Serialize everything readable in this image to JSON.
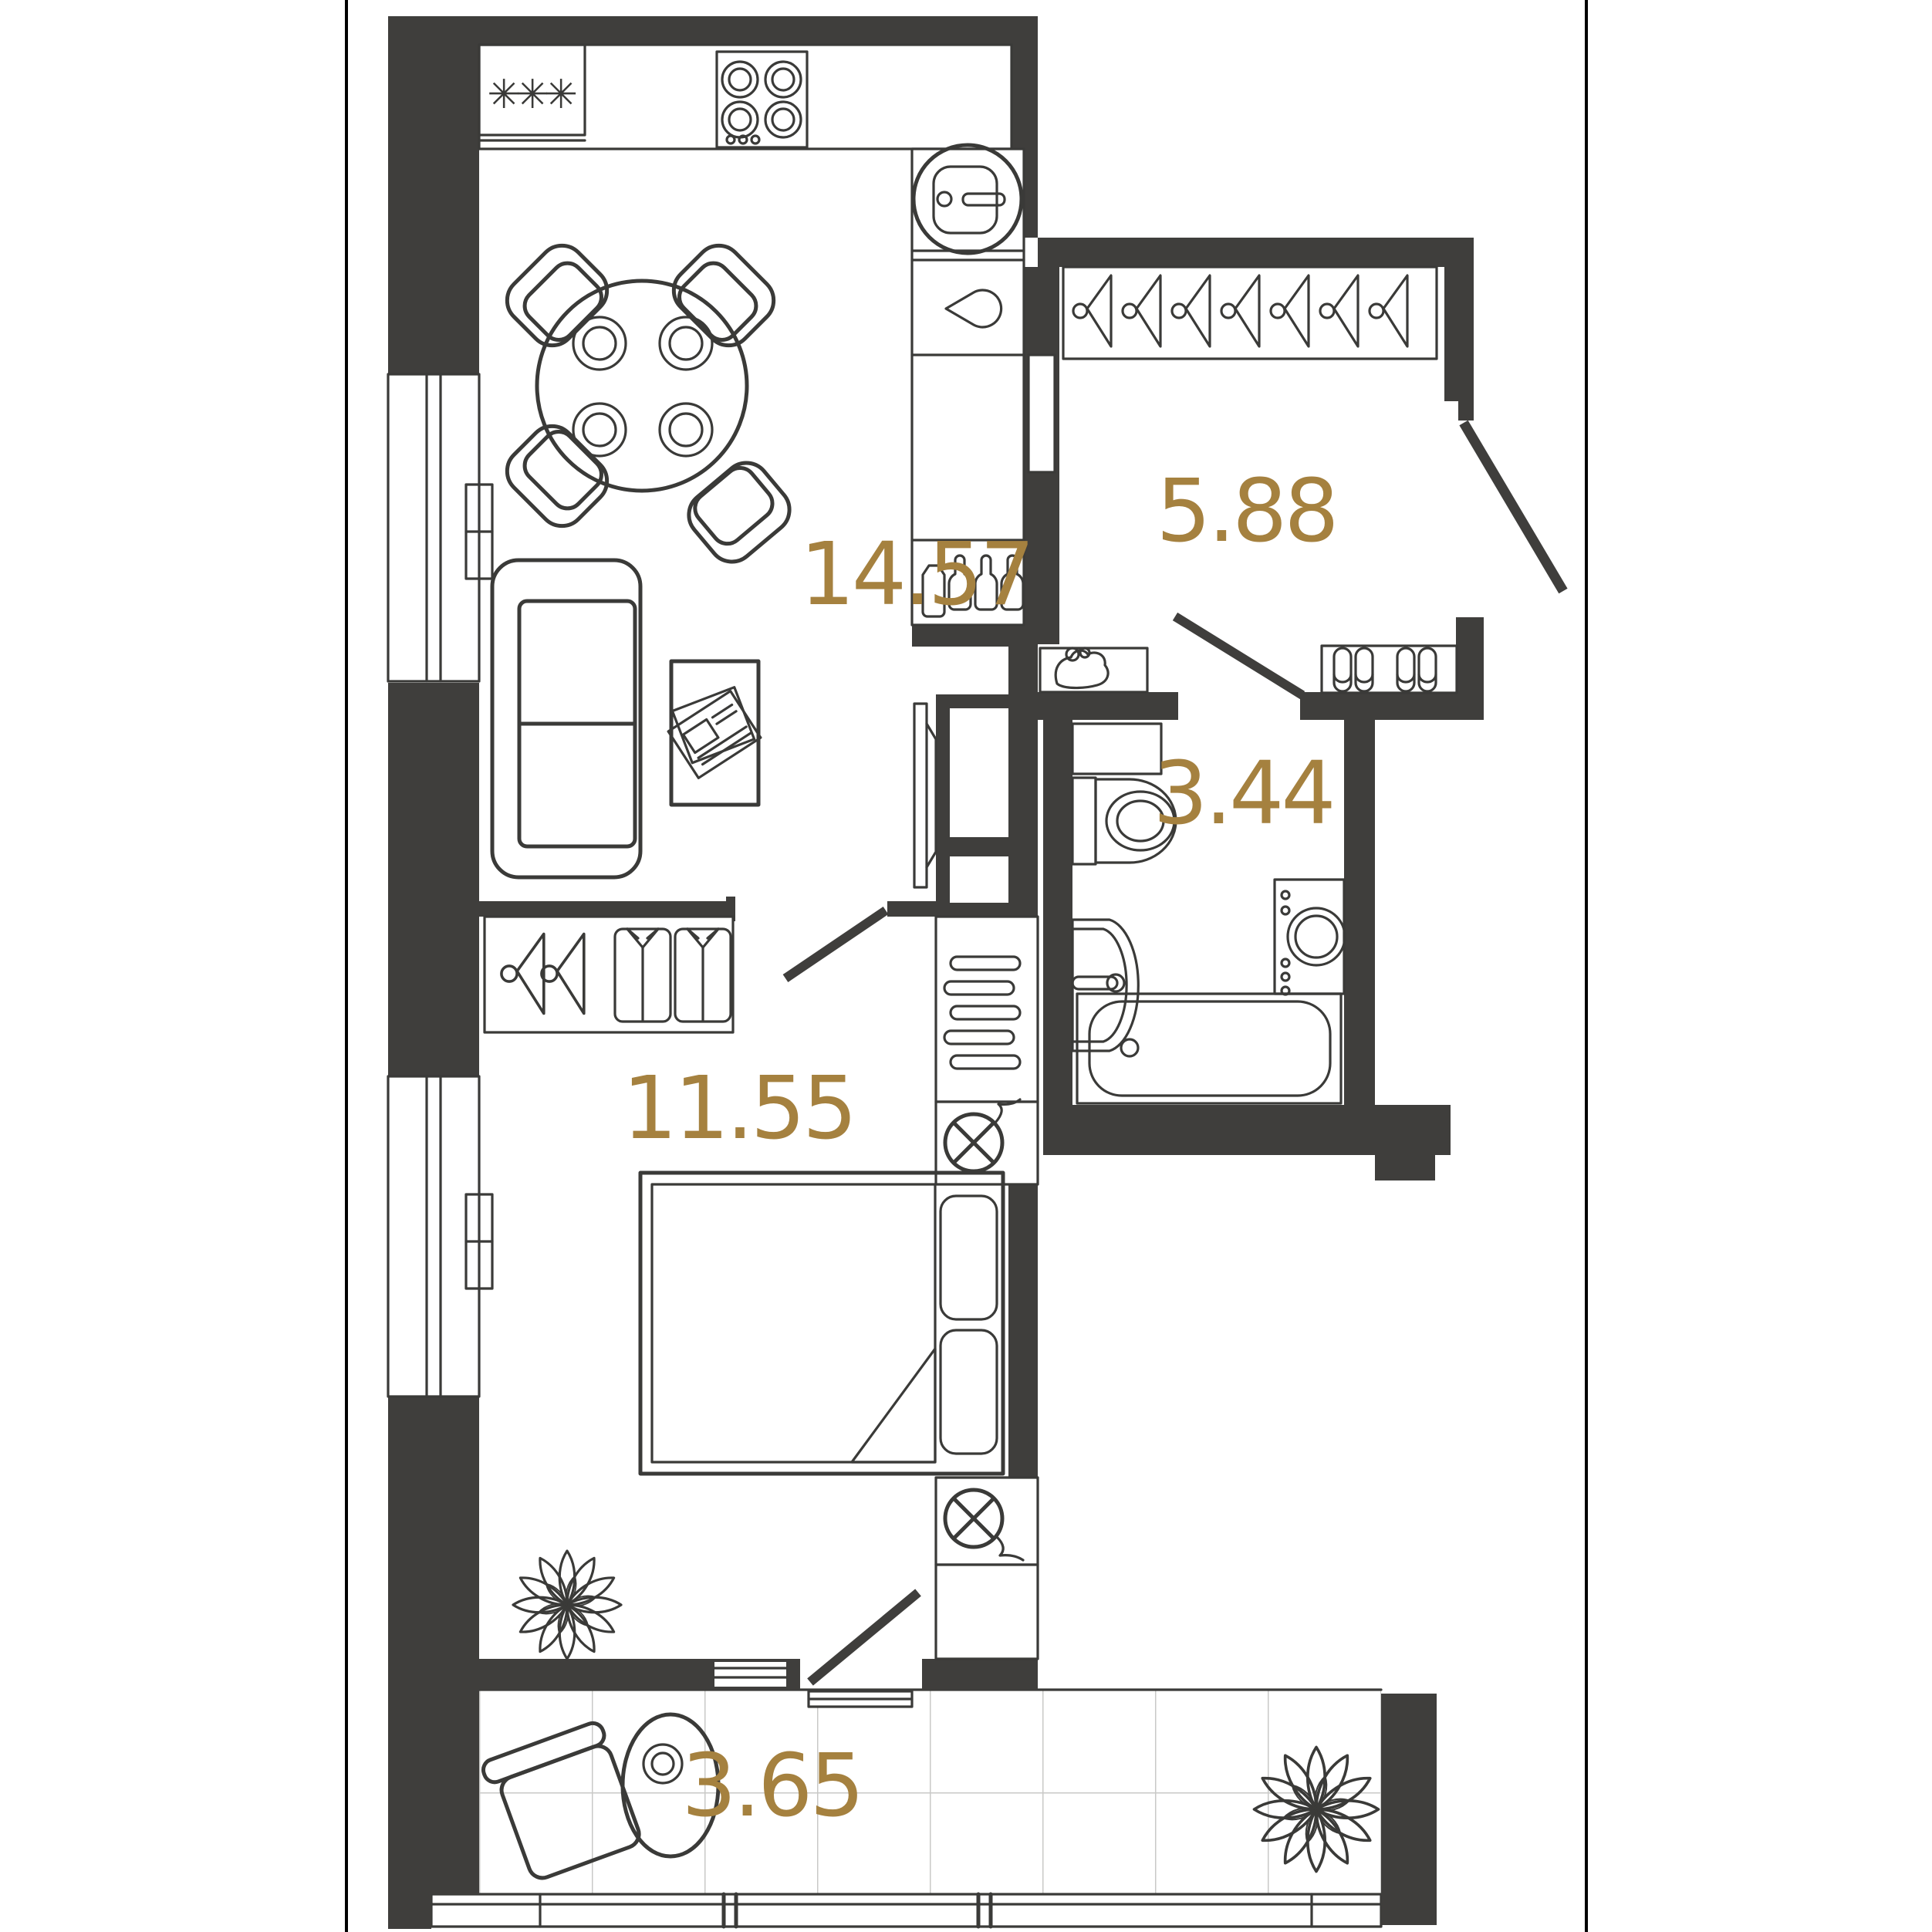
{
  "plan": {
    "type": "apartment-floor-plan",
    "colors": {
      "wall": "#3f3e3c",
      "furniture_line": "#3a3a38",
      "area_label": "#a5813f",
      "background": "#ffffff",
      "tile_line": "#c9c9c7",
      "page_border": "#000000"
    },
    "rooms": {
      "kitchen_living": {
        "area": "14.57"
      },
      "hallway": {
        "area": "5.88"
      },
      "bathroom": {
        "area": "3.44"
      },
      "bedroom": {
        "area": "11.55"
      },
      "balcony": {
        "area": "3.65"
      }
    },
    "icons": {
      "kitchen": [
        "freezer-asterisks-icon",
        "stove-burners-icon",
        "round-sink-icon",
        "dishwasher-drop-icon",
        "bottles-icon"
      ],
      "living": [
        "dining-table-icon",
        "chair-icon",
        "sofa-icon",
        "coffee-table-newspaper-icon",
        "tv-icon"
      ],
      "hallway_icons": [
        "coat-hanger-icon",
        "shoe-rack-slippers-icon",
        "purse-shelf-icon",
        "entry-door-swing"
      ],
      "bathroom_icons": [
        "toilet-icon",
        "washbasin-icon",
        "washing-machine-icon",
        "bathtub-icon"
      ],
      "bedroom_icons": [
        "double-bed-icon",
        "pillow-icon",
        "wardrobe-hanger-icon",
        "folded-shirt-icon",
        "vent-grille-icon",
        "light-fixture-crossed-circle-icon",
        "plant-icon"
      ],
      "balcony_icons": [
        "lounge-chair-icon",
        "side-table-icon",
        "plant-icon",
        "glazing-frame"
      ]
    }
  }
}
